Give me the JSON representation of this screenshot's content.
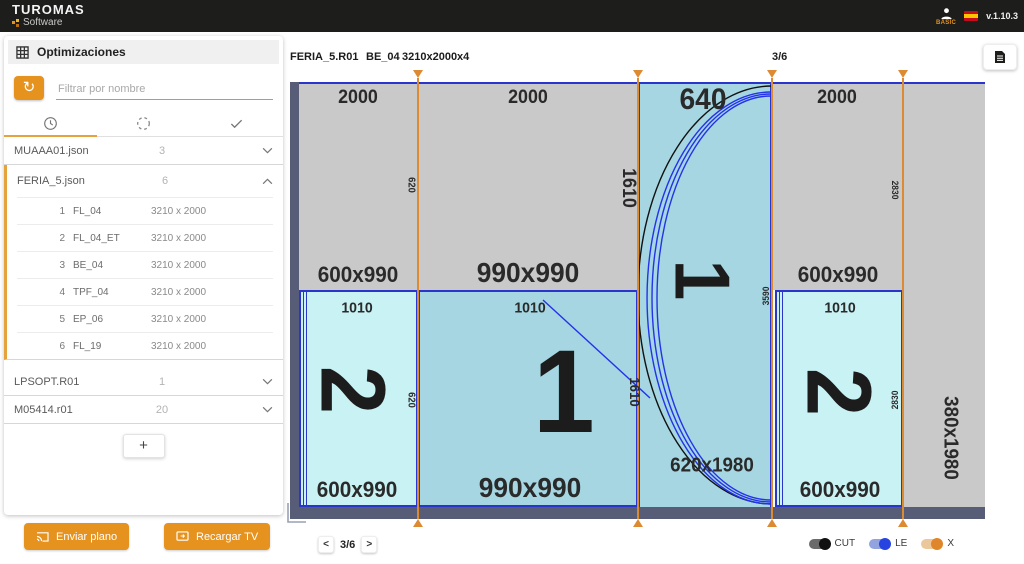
{
  "topbar": {
    "logo_title": "TUROMAS",
    "logo_subtitle": "Software",
    "user_label": "BASIC",
    "version": "v.1.10.3"
  },
  "sidebar": {
    "title": "Optimizaciones",
    "filter_placeholder": "Filtrar por nombre",
    "groups": [
      {
        "name": "MUAAA01.json",
        "count": "3"
      },
      {
        "name": "FERIA_5.json",
        "count": "6",
        "items": [
          {
            "num": "1",
            "name": "FL_04",
            "size": "3210 x 2000"
          },
          {
            "num": "2",
            "name": "FL_04_ET",
            "size": "3210 x 2000"
          },
          {
            "num": "3",
            "name": "BE_04",
            "size": "3210 x 2000"
          },
          {
            "num": "4",
            "name": "TPF_04",
            "size": "3210 x 2000"
          },
          {
            "num": "5",
            "name": "EP_06",
            "size": "3210 x 2000"
          },
          {
            "num": "6",
            "name": "FL_19",
            "size": "3210 x 2000"
          }
        ]
      },
      {
        "name": "LPSOPT.R01",
        "count": "1"
      },
      {
        "name": "M05414.r01",
        "count": "20"
      }
    ],
    "add_label": "+",
    "send_label": "Enviar plano",
    "reload_label": "Recargar TV"
  },
  "main": {
    "plan_name": "FERIA_5.R01",
    "piece_name": "BE_04",
    "sheet_size": "3210x2000x4",
    "page_indicator": "3/6",
    "pagination": {
      "prev": "<",
      "label": "3/6",
      "next": ">"
    },
    "toggles": {
      "cut": "CUT",
      "le": "LE",
      "x": "X"
    }
  },
  "diagram": {
    "top_dims": [
      "2000",
      "2000",
      "640",
      "2000"
    ],
    "pieces": {
      "r1": "600x990",
      "r2": "990x990",
      "r4": "600x990",
      "r5_dim": "1010",
      "r6_dim": "1010",
      "r7_dim": "1010",
      "r5": "600x990",
      "r6": "990x990",
      "r7": "600x990",
      "r3": "620x1980",
      "r8": "380x1980"
    },
    "digits": {
      "strip": "1",
      "bottom_left": "2",
      "bottom_mid": "1",
      "bottom_right": "2"
    },
    "cut_labels": {
      "l1_top": "620",
      "l1_bot": "620",
      "l2_top": "1610",
      "l2_bot": "1610",
      "l3": "3590",
      "l4_top": "2830",
      "l4_bot": "2830"
    }
  },
  "colors": {
    "accent_orange": "#e6921e",
    "cut_line_orange": "#dd8b33",
    "piece_blue_border": "#2a35cc",
    "waste_gray": "#c9c9c9",
    "piece_cyan": "#a5d6e2",
    "piece_light_cyan": "#c9f2f4",
    "sheet_edge": "#575d77",
    "topbar_bg": "#1d1d1b"
  }
}
